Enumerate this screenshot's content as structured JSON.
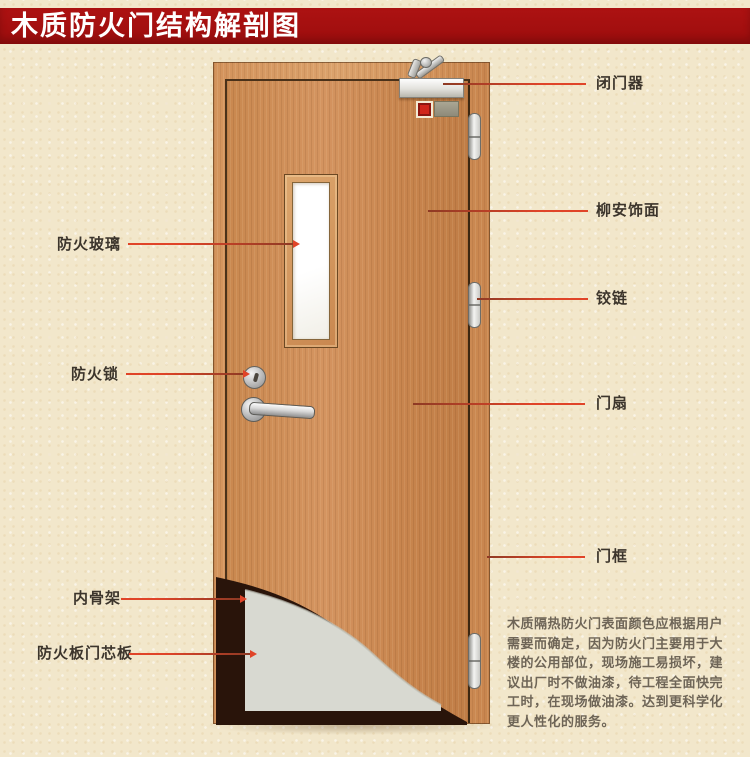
{
  "title": "木质防火门结构解剖图",
  "callouts": {
    "fire_glass": "防火玻璃",
    "fire_lock": "防火锁",
    "inner_frame": "内骨架",
    "core_board": "防火板门芯板",
    "door_closer": "闭门器",
    "veneer": "柳安饰面",
    "hinge": "铰链",
    "door_leaf": "门扇",
    "door_frame": "门框"
  },
  "description": {
    "lines": [
      "木质隔热防火门表面颜色应根据用户",
      "需要而确定，因为防火门主要用于大",
      "楼的公用部位，现场施工易损坏，建",
      "议出厂时不做油漆，待工程全面快完",
      "工时，在现场做油漆。达到更科学化",
      "更人性化的服务。"
    ]
  },
  "colors": {
    "banner": "#a50f0f",
    "leader_line": "#d24127",
    "wood": "#c98a55",
    "core_panel": "#d8d9d1",
    "paper": "#f2e7cb",
    "glass": "#ffffff",
    "label_text": "#3c352c"
  }
}
